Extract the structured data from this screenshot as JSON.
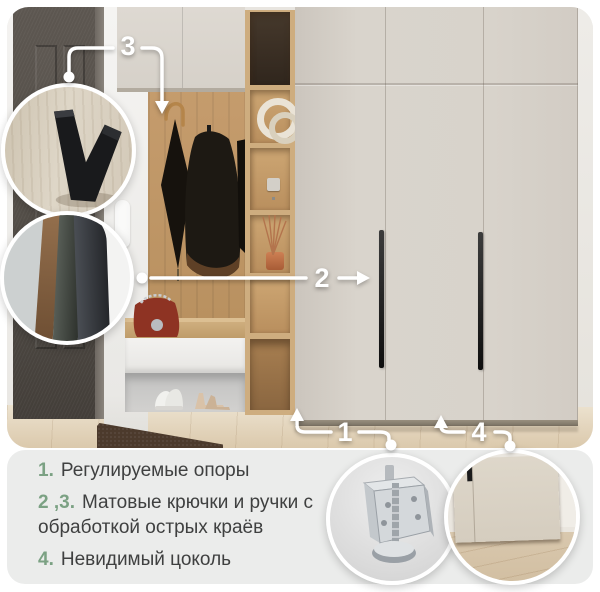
{
  "callouts": {
    "one": "1",
    "two": "2",
    "three": "3",
    "four": "4"
  },
  "legend": {
    "items": [
      {
        "num": "1.",
        "text": "Регулируемые опоры"
      },
      {
        "num": "2 ,3.",
        "text": "Матовые крючки и ручки с\nобработкой острых краёв"
      },
      {
        "num": "4.",
        "text": "Невидимый цоколь"
      }
    ]
  },
  "colors": {
    "accent_green": "#7ba183",
    "legend_text": "#3f4040",
    "panel_bg": "#ebeceb",
    "annotation": "#ffffff",
    "wardrobe_cream": "#d7d2ca",
    "oak_wood": "#c19a6c"
  },
  "icons": {
    "hook_inset": "v-hook-closeup",
    "handle_inset": "matte-handle-closeup",
    "foot_inset": "adjustable-foot-closeup",
    "plinth_inset": "invisible-plinth-closeup"
  }
}
